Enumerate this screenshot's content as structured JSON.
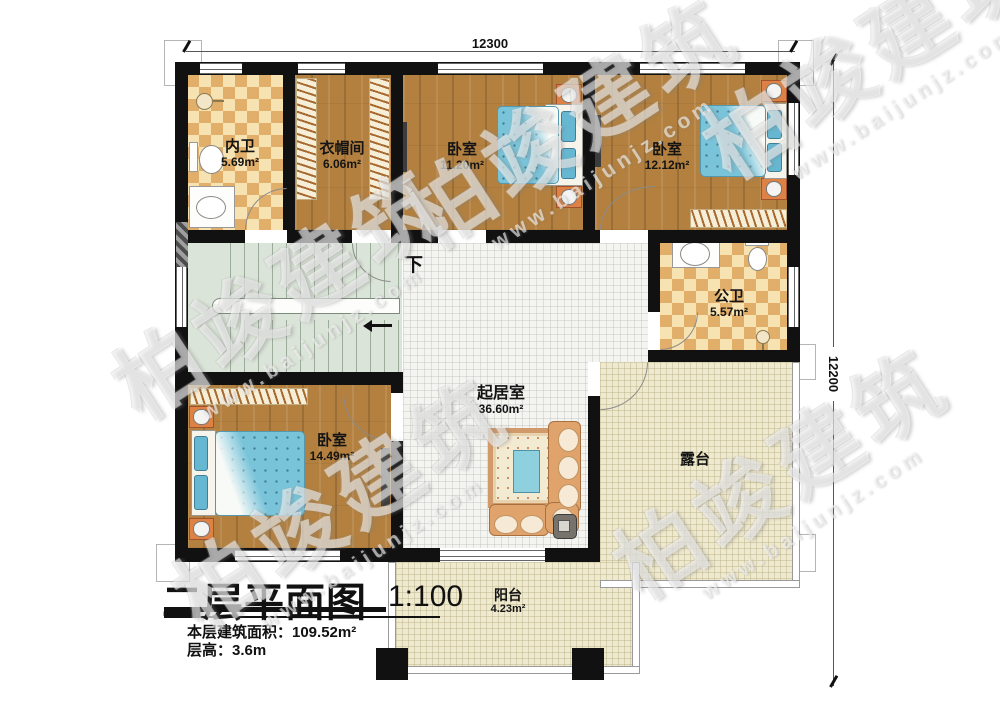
{
  "title_block": {
    "title": "二层平面图",
    "scale": "1:100",
    "floor_area": "本层建筑面积：109.52m²",
    "floor_height": "层高：3.6m"
  },
  "dimensions": {
    "top": "12300",
    "right": "12200"
  },
  "stairs": {
    "down_label": "下"
  },
  "rooms": {
    "inner_bath": {
      "name": "内卫",
      "area": "5.69m²"
    },
    "cloakroom": {
      "name": "衣帽间",
      "area": "6.06m²"
    },
    "bedroom_top": {
      "name": "卧室",
      "area": "11.20m²"
    },
    "bedroom_right": {
      "name": "卧室",
      "area": "12.12m²"
    },
    "public_bath": {
      "name": "公卫",
      "area": "5.57m²"
    },
    "bedroom_bottom": {
      "name": "卧室",
      "area": "14.49m²"
    },
    "living_room": {
      "name": "起居室",
      "area": "36.60m²"
    },
    "terrace": {
      "name": "露台"
    },
    "balcony": {
      "name": "阳台",
      "area": "4.23m²"
    }
  },
  "watermark": {
    "brand": "柏竣建筑",
    "url": "www.baijunjz.com"
  },
  "colors": {
    "wall": "#111111",
    "wood_floor": "#b3803f",
    "tile_light": "#f7e3b2",
    "tile_dark": "#e2af6b",
    "bed_blue": "#7ac4da",
    "stair_green": "#dbe4d8",
    "terrace_beige": "#efe9cf",
    "sofa_tan": "#dfa36b"
  }
}
